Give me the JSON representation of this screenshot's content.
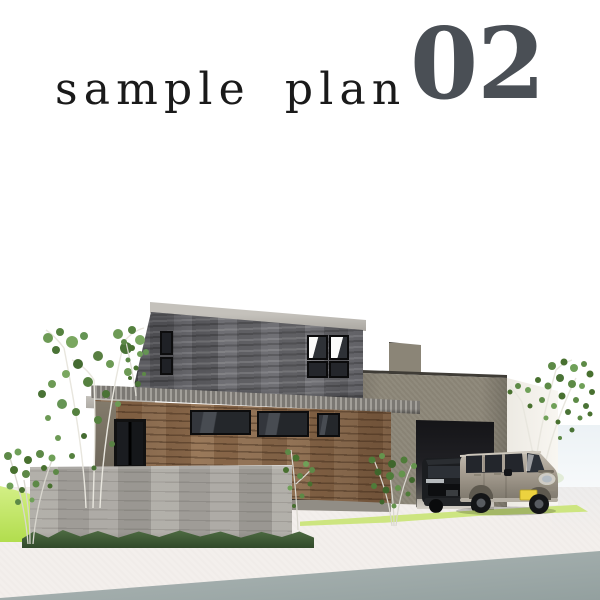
{
  "header": {
    "title": "sample plan",
    "number": "02",
    "title_color": "#1a1a1a",
    "number_color": "#4a4f55"
  },
  "scene": {
    "colors": {
      "background": "#ffffff",
      "upper_floor_stone": "#65656a",
      "roof_fascia": "#b8b5af",
      "lower_floor_wood": "#8e6d4f",
      "garage_stucco": "#8d8779",
      "garage_interior_dark": "#141417",
      "fence_concrete": "#aba8a2",
      "lawn_lime": "#b2dd4e",
      "grass_dark": "#31492a",
      "driveway": "#f3efec",
      "road": "#9aa5a4",
      "kei_car_body": "#a89f92",
      "dark_car_body": "#1b1d20",
      "license_plate_yellow": "#ecd23f",
      "tree_foliage": "#5d8a46",
      "tree_trunk": "#e8e6de"
    }
  }
}
